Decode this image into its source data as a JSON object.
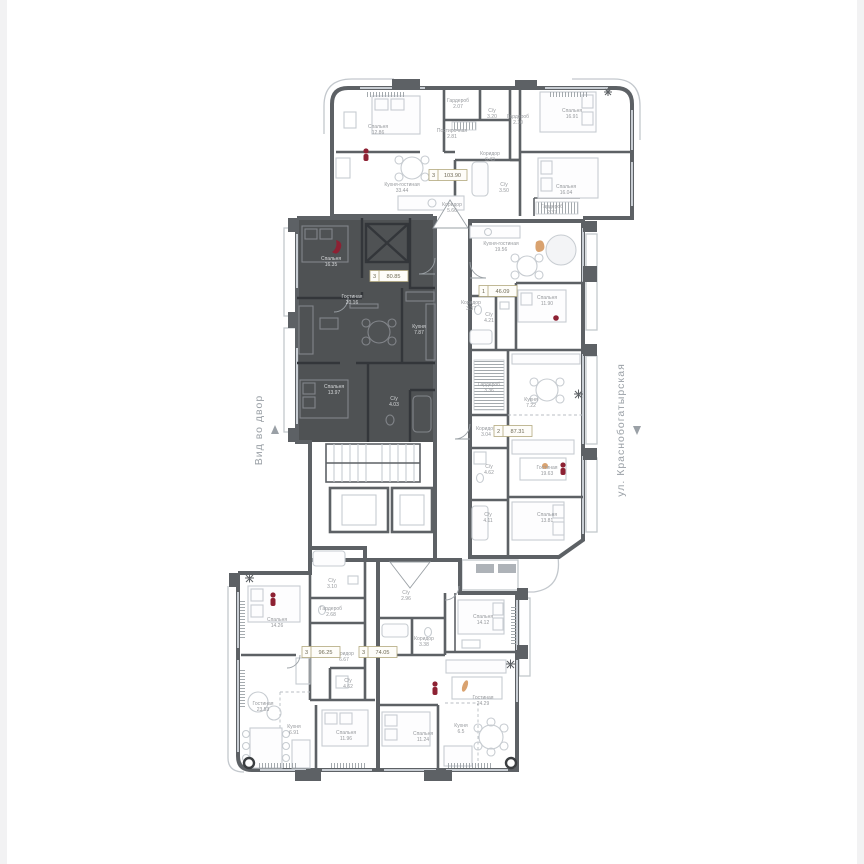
{
  "scene": {
    "left_label": "Вид во двор",
    "right_label": "ул. Краснобогатырская"
  },
  "apartments": [
    {
      "id": "apt-top",
      "badge": {
        "rooms": "3",
        "area": "103.90"
      },
      "rooms": [
        {
          "name": "Спальня",
          "area": "12.86"
        },
        {
          "name": "Кухня-гостиная",
          "area": "33.44"
        },
        {
          "name": "Гардероб",
          "area": "2.07"
        },
        {
          "name": "Постирочная",
          "area": "2.81"
        },
        {
          "name": "С/у",
          "area": "3.20"
        },
        {
          "name": "Гардероб",
          "area": "2.10"
        },
        {
          "name": "Коридор",
          "area": "6.43"
        },
        {
          "name": "С/у",
          "area": "3.50"
        },
        {
          "name": "Коридор",
          "area": "5.66"
        },
        {
          "name": "Спальня",
          "area": "16.91"
        },
        {
          "name": "Спальня",
          "area": "16.04"
        },
        {
          "name": "Гардероб",
          "area": "2.37"
        }
      ]
    },
    {
      "id": "apt-dark",
      "highlighted": true,
      "badge": {
        "rooms": "3",
        "area": "80.85"
      },
      "rooms": [
        {
          "name": "Спальня",
          "area": "16.35"
        },
        {
          "name": "Гостиная",
          "area": "20.16"
        },
        {
          "name": "Кухня",
          "area": "7.87"
        },
        {
          "name": "Спальня",
          "area": "13.97"
        },
        {
          "name": "С/у",
          "area": "4.03"
        }
      ]
    },
    {
      "id": "apt-1room",
      "badge": {
        "rooms": "1",
        "area": "46.09"
      },
      "rooms": [
        {
          "name": "Кухня-гостиная",
          "area": "19.56"
        },
        {
          "name": "Коридор",
          "area": "3.37"
        },
        {
          "name": "С/у",
          "area": "4.21"
        },
        {
          "name": "Спальня",
          "area": "11.90"
        }
      ]
    },
    {
      "id": "apt-2room",
      "badge": {
        "rooms": "2",
        "area": "87.31"
      },
      "rooms": [
        {
          "name": "Кухня",
          "area": "7.22"
        },
        {
          "name": "Гардероб",
          "area": "3.36"
        },
        {
          "name": "Коридор",
          "area": "3.04"
        },
        {
          "name": "С/у",
          "area": "4.62"
        },
        {
          "name": "Гостиная",
          "area": "19.63"
        },
        {
          "name": "С/у",
          "area": "4.11"
        },
        {
          "name": "Спальня",
          "area": "13.81"
        }
      ]
    },
    {
      "id": "apt-bottom-left",
      "badge": {
        "rooms": "3",
        "area": "96.25"
      },
      "rooms": [
        {
          "name": "Спальня",
          "area": "14.26"
        },
        {
          "name": "С/у",
          "area": "3.10"
        },
        {
          "name": "Гардероб",
          "area": "2.68"
        },
        {
          "name": "Коридор",
          "area": "6.67"
        },
        {
          "name": "С/у",
          "area": "4.62"
        },
        {
          "name": "Гостиная",
          "area": "23.53"
        },
        {
          "name": "Кухня",
          "area": "6.91"
        },
        {
          "name": "Спальня",
          "area": "11.96"
        }
      ]
    },
    {
      "id": "apt-bottom-right",
      "badge": {
        "rooms": "3",
        "area": "74.05"
      },
      "rooms": [
        {
          "name": "С/у",
          "area": "2.96"
        },
        {
          "name": "Коридор",
          "area": "3.38"
        },
        {
          "name": "Спальня",
          "area": "14.12"
        },
        {
          "name": "Гостиная",
          "area": "24.29"
        },
        {
          "name": "Кухня",
          "area": "6.5"
        },
        {
          "name": "Спальня",
          "area": "11.24"
        }
      ]
    }
  ]
}
